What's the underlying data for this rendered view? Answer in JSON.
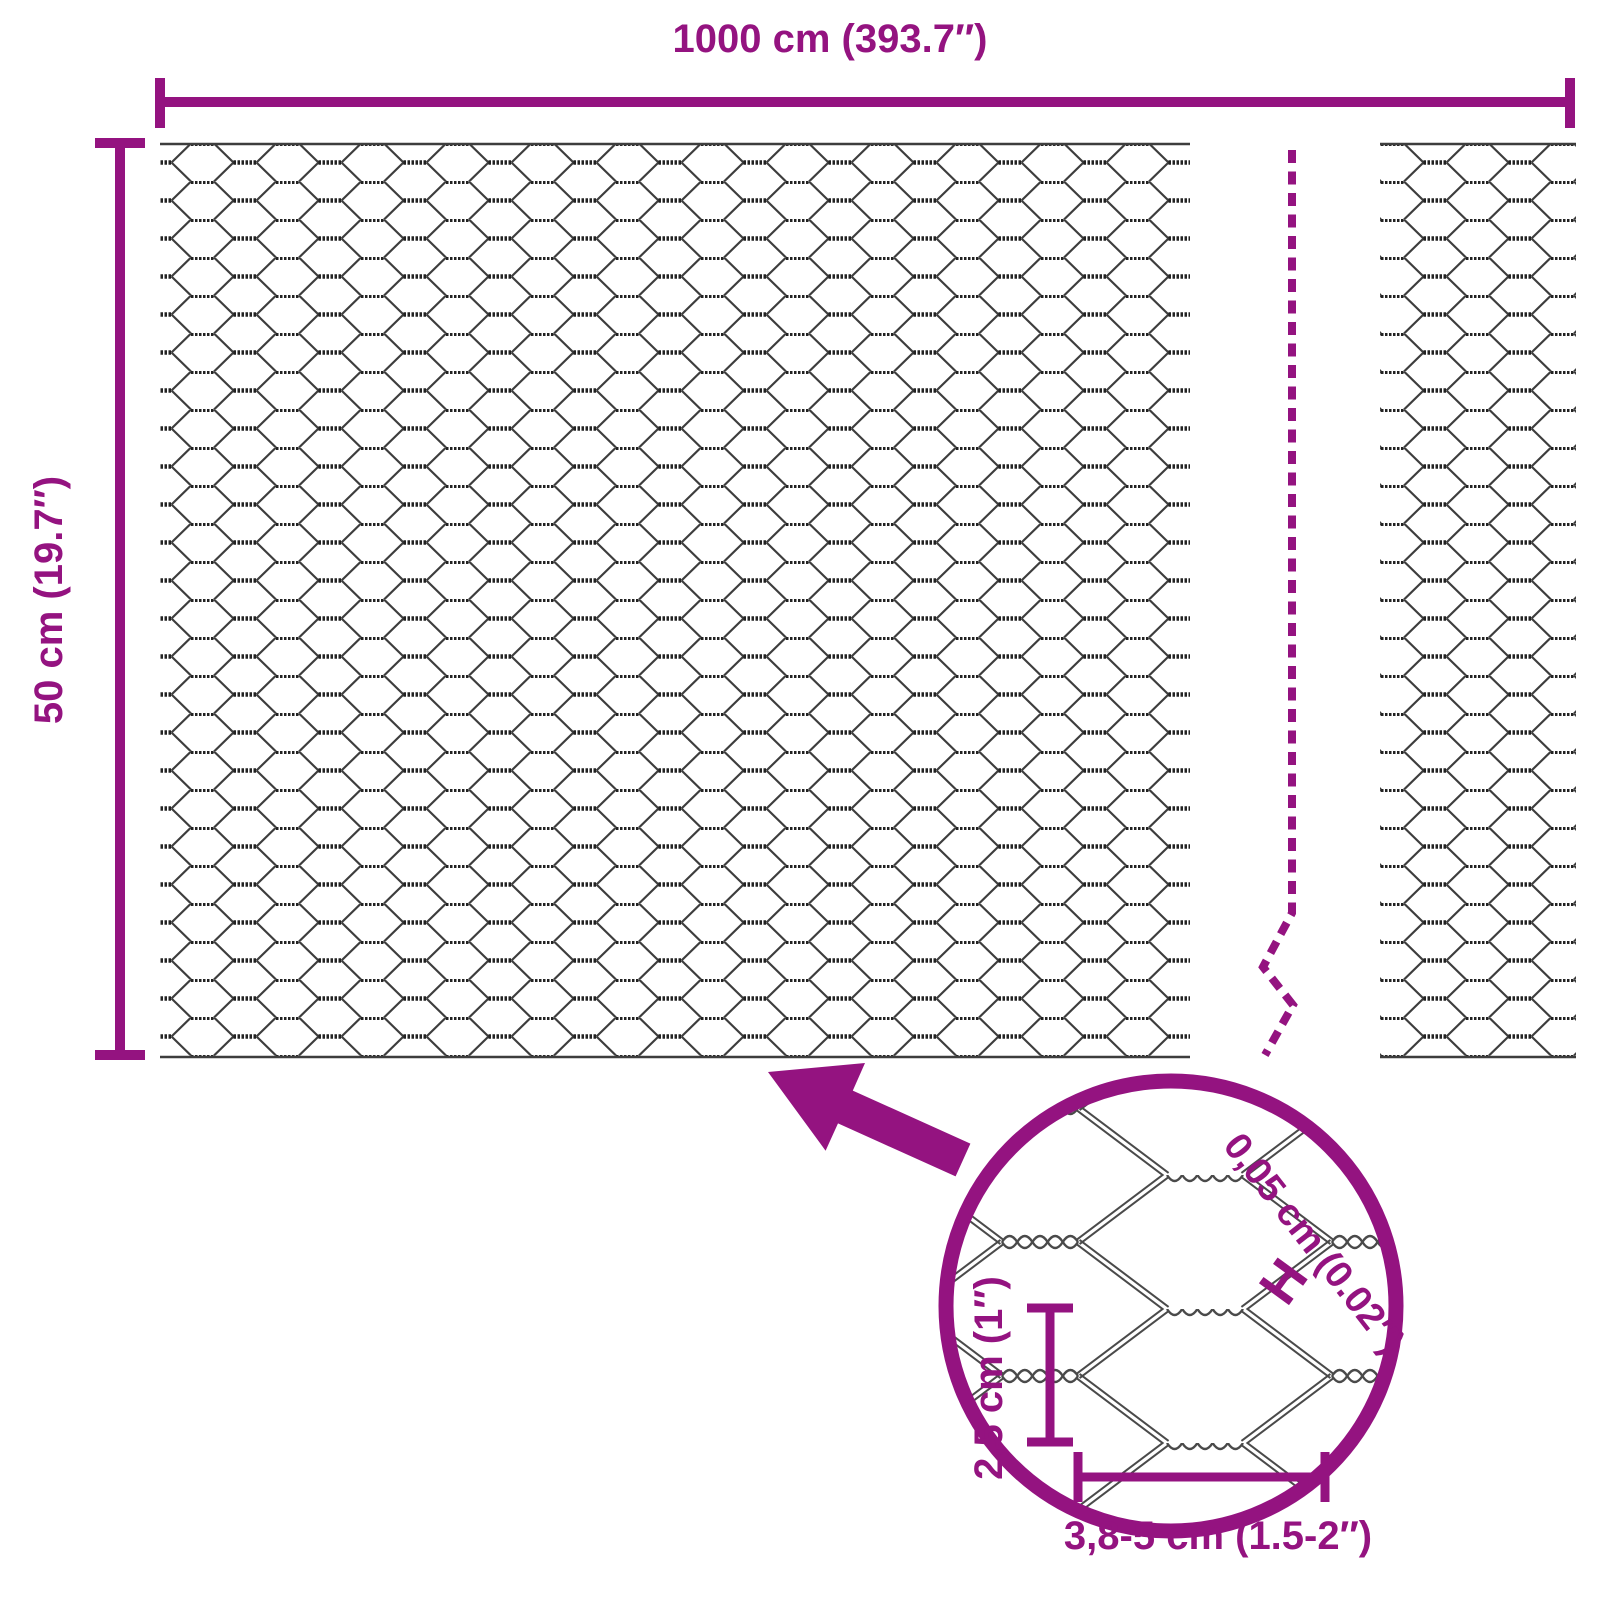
{
  "colors": {
    "accent": "#941380",
    "wire": "#3d3d3d",
    "wire_dark": "#222222",
    "background": "#ffffff"
  },
  "labels": {
    "panel_width": "1000 cm (393.7″)",
    "panel_height": "50 cm (19.7″)"
  },
  "detail_labels": {
    "wire_thickness": "0,05 cm (0.02″)",
    "wire_thickness_marker": "H",
    "mesh_height": "2,5 cm (1″)",
    "mesh_width": "3,8-5 cm (1.5-2″)"
  },
  "icons": {
    "zoom_arrow": "solid-arrow",
    "break_line": "dashed-continuation-line"
  }
}
